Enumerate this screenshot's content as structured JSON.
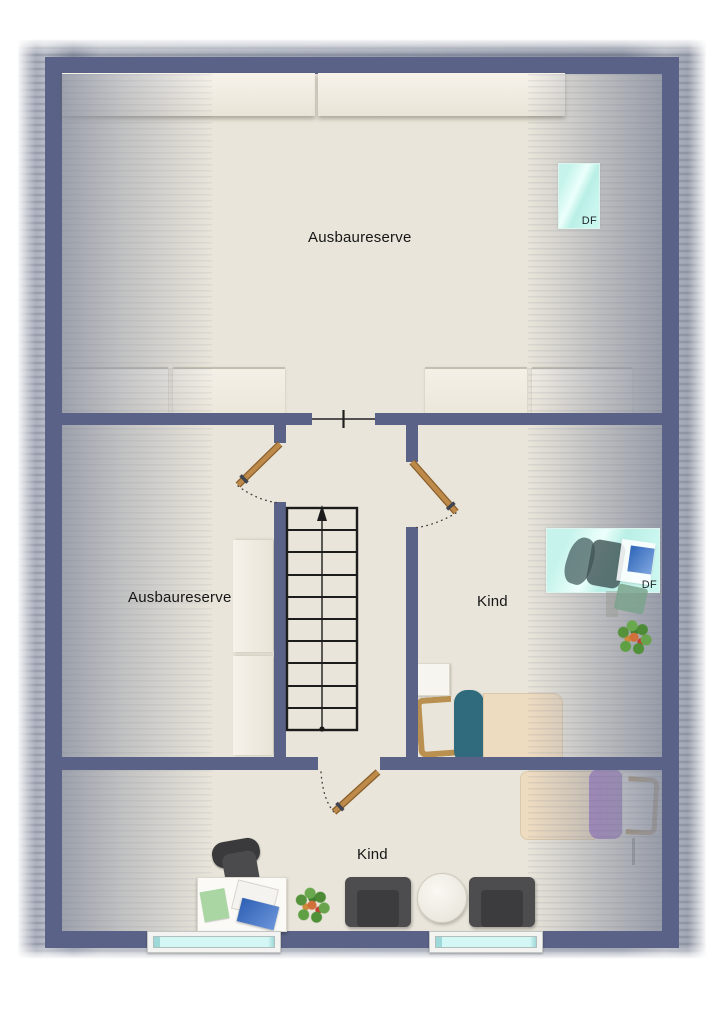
{
  "plan": {
    "rooms": [
      {
        "id": "top",
        "label": "Ausbaureserve"
      },
      {
        "id": "middle-left",
        "label": "Ausbaureserve"
      },
      {
        "id": "middle-right",
        "label": "Kind"
      },
      {
        "id": "bottom",
        "label": "Kind"
      }
    ],
    "roof_windows": [
      {
        "id": "top",
        "label": "DF"
      },
      {
        "id": "middle",
        "label": "DF"
      }
    ],
    "colors": {
      "wall": "#5a6287",
      "floor": "#e9e5da",
      "roof_border": "#9ba1ae",
      "roof_window_glass": "#c6f4ec",
      "facade_window_glass": "#d2f7f5",
      "door_leaf": "#b5823f",
      "stair_lines": "#1a1a1a"
    }
  }
}
